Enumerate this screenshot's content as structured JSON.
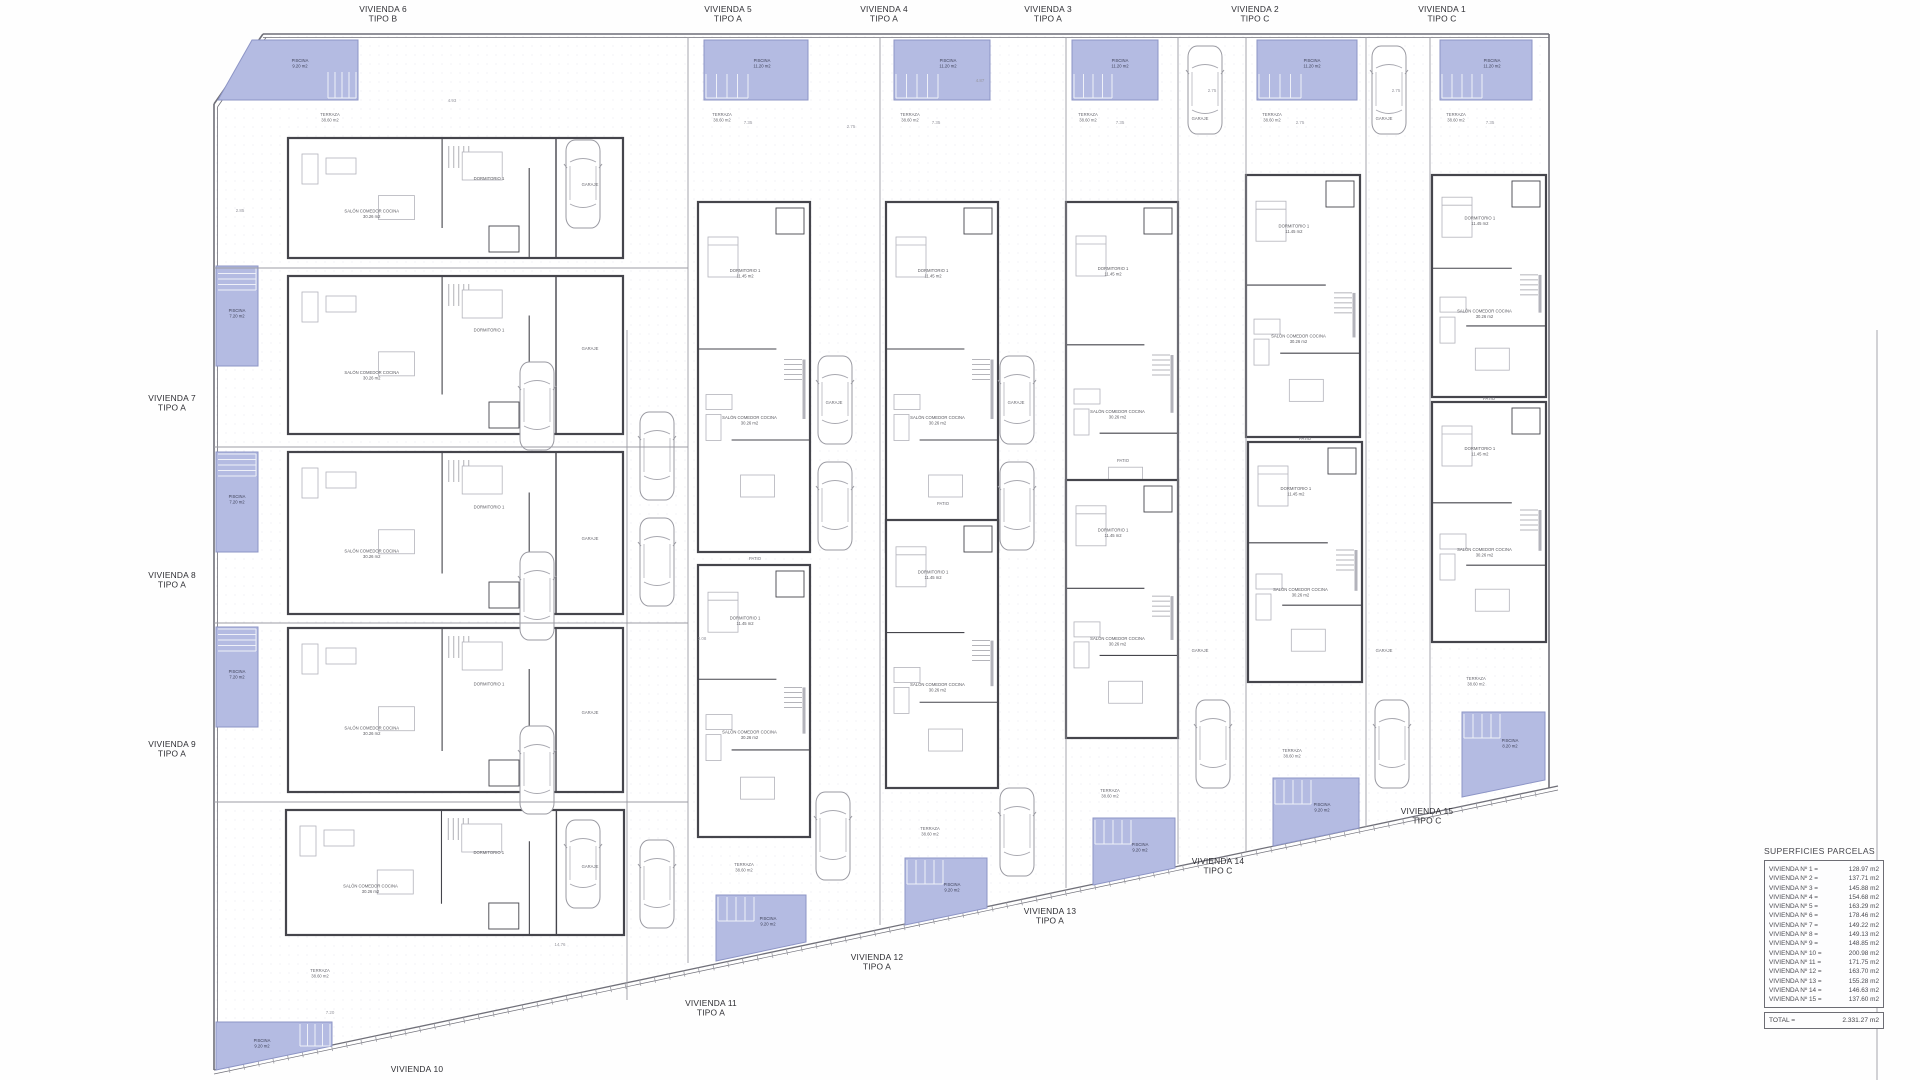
{
  "palette": {
    "pool_fill": "#b4bbe2",
    "pool_edge": "#8d95c6",
    "pool_text": "#3f4258",
    "wall": "#45454c",
    "lite": "#9c9ca4",
    "furn": "#b3b3bb",
    "faint": "#d9d9e0",
    "text": "#2e2e33",
    "gray": "#96969e",
    "stair": "#eef0f8"
  },
  "strings": {
    "salon": "SALÓN COMEDOR COCINA",
    "salon_area": "30.26 m2",
    "dorm": "DORMITORIO 1",
    "dorm_area": "11.45 m2",
    "terraza": "TERRAZA",
    "terraza_area": "38.60 m2",
    "piscina": "PISCINA",
    "garaje": "GARAJE",
    "patio": "PATIO",
    "bano": "BAÑO 1"
  },
  "table": {
    "title": "SUPERFICIES PARCELAS",
    "rows": [
      {
        "label": "VIVIENDA Nº 1 =",
        "value": "128.97 m2"
      },
      {
        "label": "VIVIENDA Nº 2 =",
        "value": "137.71 m2"
      },
      {
        "label": "VIVIENDA Nº 3 =",
        "value": "145.88 m2"
      },
      {
        "label": "VIVIENDA Nº 4 =",
        "value": "154.68 m2"
      },
      {
        "label": "VIVIENDA Nº 5 =",
        "value": "163.29 m2"
      },
      {
        "label": "VIVIENDA Nº 6 =",
        "value": "178.46 m2"
      },
      {
        "label": "VIVIENDA Nº 7 =",
        "value": "149.22 m2"
      },
      {
        "label": "VIVIENDA Nº 8 =",
        "value": "149.13 m2"
      },
      {
        "label": "VIVIENDA Nº 9 =",
        "value": "148.85 m2"
      },
      {
        "label": "VIVIENDA Nº 10 =",
        "value": "200.98 m2"
      },
      {
        "label": "VIVIENDA Nº 11 =",
        "value": "171.75 m2"
      },
      {
        "label": "VIVIENDA Nº 12 =",
        "value": "163.70 m2"
      },
      {
        "label": "VIVIENDA Nº 13 =",
        "value": "155.28 m2"
      },
      {
        "label": "VIVIENDA Nº 14 =",
        "value": "146.63 m2"
      },
      {
        "label": "VIVIENDA Nº 15 =",
        "value": "137.60 m2"
      }
    ],
    "total_label": "TOTAL =",
    "total_value": "2.331.27 m2"
  },
  "plan": {
    "unit_labels": [
      {
        "line1": "VIVIENDA 6",
        "line2": "TIPO B",
        "x": 383,
        "y": 12
      },
      {
        "line1": "VIVIENDA 5",
        "line2": "TIPO A",
        "x": 728,
        "y": 12
      },
      {
        "line1": "VIVIENDA 4",
        "line2": "TIPO A",
        "x": 884,
        "y": 12
      },
      {
        "line1": "VIVIENDA 3",
        "line2": "TIPO A",
        "x": 1048,
        "y": 12
      },
      {
        "line1": "VIVIENDA 2",
        "line2": "TIPO C",
        "x": 1255,
        "y": 12
      },
      {
        "line1": "VIVIENDA 1",
        "line2": "TIPO C",
        "x": 1442,
        "y": 12
      },
      {
        "line1": "VIVIENDA 7",
        "line2": "TIPO A",
        "x": 172,
        "y": 401
      },
      {
        "line1": "VIVIENDA 8",
        "line2": "TIPO A",
        "x": 172,
        "y": 578
      },
      {
        "line1": "VIVIENDA 9",
        "line2": "TIPO A",
        "x": 172,
        "y": 747
      },
      {
        "line1": "VIVIENDA 10",
        "line2": "",
        "x": 417,
        "y": 1072
      },
      {
        "line1": "VIVIENDA 11",
        "line2": "TIPO A",
        "x": 711,
        "y": 1006
      },
      {
        "line1": "VIVIENDA 12",
        "line2": "TIPO A",
        "x": 877,
        "y": 960
      },
      {
        "line1": "VIVIENDA 13",
        "line2": "TIPO A",
        "x": 1050,
        "y": 914
      },
      {
        "line1": "VIVIENDA 14",
        "line2": "TIPO C",
        "x": 1218,
        "y": 864
      },
      {
        "line1": "VIVIENDA 15",
        "line2": "TIPO C",
        "x": 1427,
        "y": 814
      }
    ],
    "boundary": [
      {
        "p": [
          263,
          34,
          1549,
          34
        ],
        "w": 1.6
      },
      {
        "p": [
          263,
          37.5,
          1549,
          37.5
        ],
        "w": 0.8
      },
      {
        "p": [
          214,
          104,
          263,
          34
        ],
        "w": 1.6
      },
      {
        "p": [
          217.5,
          107,
          266,
          37.5
        ],
        "w": 0.8
      },
      {
        "p": [
          214,
          104,
          214,
          1070
        ],
        "w": 1.6
      },
      {
        "p": [
          217.5,
          107,
          217.5,
          1068
        ],
        "w": 0.8
      },
      {
        "p": [
          1549,
          34,
          1549,
          788
        ],
        "w": 1.6
      },
      {
        "p": [
          214,
          1070,
          1558,
          786
        ],
        "w": 1.3
      },
      {
        "p": [
          214,
          1074,
          1558,
          790
        ],
        "w": 0.7
      }
    ],
    "party_lines": [
      [
        688,
        37,
        688,
        963
      ],
      [
        880,
        37,
        880,
        925
      ],
      [
        1066,
        37,
        1066,
        888
      ],
      [
        1178,
        37,
        1178,
        864
      ],
      [
        1246,
        37,
        1246,
        851
      ],
      [
        1366,
        37,
        1366,
        827
      ],
      [
        1430,
        37,
        1430,
        814
      ],
      [
        627,
        330,
        627,
        1000
      ],
      [
        214,
        268,
        688,
        268
      ],
      [
        214,
        447,
        688,
        447
      ],
      [
        214,
        623,
        688,
        623
      ],
      [
        214,
        802,
        688,
        802
      ],
      [
        1877,
        330,
        1877,
        1080
      ]
    ],
    "pools": [
      {
        "pts": "252,40 358,40 358,100 218,100",
        "stair": {
          "x": 328,
          "y": 72,
          "w": 28,
          "h": 26,
          "d": "v"
        },
        "lx": 300,
        "ly": 62,
        "area": "9.20 m2"
      },
      {
        "pts": "704,40 808,40 808,100 704,100",
        "stair": {
          "x": 706,
          "y": 74,
          "w": 42,
          "h": 24,
          "d": "v"
        },
        "lx": 762,
        "ly": 62,
        "area": "11.20 m2"
      },
      {
        "pts": "894,40 990,40 990,100 894,100",
        "stair": {
          "x": 896,
          "y": 74,
          "w": 42,
          "h": 24,
          "d": "v"
        },
        "lx": 948,
        "ly": 62,
        "area": "11.20 m2"
      },
      {
        "pts": "1072,40 1158,40 1158,100 1072,100",
        "stair": {
          "x": 1074,
          "y": 74,
          "w": 38,
          "h": 24,
          "d": "v"
        },
        "lx": 1120,
        "ly": 62,
        "area": "11.20 m2"
      },
      {
        "pts": "1257,40 1357,40 1357,100 1257,100",
        "stair": {
          "x": 1259,
          "y": 74,
          "w": 42,
          "h": 24,
          "d": "v"
        },
        "lx": 1312,
        "ly": 62,
        "area": "11.20 m2"
      },
      {
        "pts": "1440,40 1532,40 1532,100 1440,100",
        "stair": {
          "x": 1442,
          "y": 74,
          "w": 40,
          "h": 24,
          "d": "v"
        },
        "lx": 1492,
        "ly": 62,
        "area": "11.20 m2"
      },
      {
        "pts": "216,266 258,266 258,366 216,366",
        "stair": {
          "x": 218,
          "y": 268,
          "w": 38,
          "h": 22,
          "d": "h"
        },
        "lx": 237,
        "ly": 312,
        "area": "7.20 m2"
      },
      {
        "pts": "216,452 258,452 258,552 216,552",
        "stair": {
          "x": 218,
          "y": 454,
          "w": 38,
          "h": 22,
          "d": "h"
        },
        "lx": 237,
        "ly": 498,
        "area": "7.20 m2"
      },
      {
        "pts": "216,627 258,627 258,727 216,727",
        "stair": {
          "x": 218,
          "y": 629,
          "w": 38,
          "h": 22,
          "d": "h"
        },
        "lx": 237,
        "ly": 673,
        "area": "7.20 m2"
      },
      {
        "pts": "216,1022 332,1022 332,1046 216,1070",
        "stair": {
          "x": 300,
          "y": 1024,
          "w": 30,
          "h": 22,
          "d": "v"
        },
        "lx": 262,
        "ly": 1042,
        "area": "9.20 m2"
      },
      {
        "pts": "716,895 806,895 806,942 716,961",
        "stair": {
          "x": 718,
          "y": 897,
          "w": 36,
          "h": 24,
          "d": "v"
        },
        "lx": 768,
        "ly": 920,
        "area": "9.20 m2"
      },
      {
        "pts": "905,858 987,858 987,908 905,925",
        "stair": {
          "x": 907,
          "y": 860,
          "w": 36,
          "h": 24,
          "d": "v"
        },
        "lx": 952,
        "ly": 886,
        "area": "9.20 m2"
      },
      {
        "pts": "1093,818 1175,818 1175,868 1093,885",
        "stair": {
          "x": 1095,
          "y": 820,
          "w": 36,
          "h": 24,
          "d": "v"
        },
        "lx": 1140,
        "ly": 846,
        "area": "9.20 m2"
      },
      {
        "pts": "1273,778 1359,778 1359,828 1273,846",
        "stair": {
          "x": 1275,
          "y": 780,
          "w": 36,
          "h": 24,
          "d": "v"
        },
        "lx": 1322,
        "ly": 806,
        "area": "9.20 m2"
      },
      {
        "pts": "1462,712 1545,712 1545,780 1462,797",
        "stair": {
          "x": 1464,
          "y": 714,
          "w": 36,
          "h": 24,
          "d": "v"
        },
        "lx": 1510,
        "ly": 742,
        "area": "8.20 m2"
      }
    ],
    "houses": [
      {
        "x": 288,
        "y": 138,
        "w": 335,
        "h": 120,
        "o": "h"
      },
      {
        "x": 288,
        "y": 276,
        "w": 335,
        "h": 158,
        "o": "h"
      },
      {
        "x": 288,
        "y": 452,
        "w": 335,
        "h": 162,
        "o": "h"
      },
      {
        "x": 288,
        "y": 628,
        "w": 335,
        "h": 164,
        "o": "h"
      },
      {
        "x": 286,
        "y": 810,
        "w": 338,
        "h": 125,
        "o": "h"
      },
      {
        "x": 698,
        "y": 202,
        "w": 112,
        "h": 350,
        "o": "v"
      },
      {
        "x": 886,
        "y": 202,
        "w": 112,
        "h": 350,
        "o": "v"
      },
      {
        "x": 1066,
        "y": 202,
        "w": 112,
        "h": 340,
        "o": "v"
      },
      {
        "x": 1246,
        "y": 175,
        "w": 114,
        "h": 262,
        "o": "v"
      },
      {
        "x": 1432,
        "y": 175,
        "w": 114,
        "h": 222,
        "o": "v"
      },
      {
        "x": 698,
        "y": 565,
        "w": 112,
        "h": 272,
        "o": "v"
      },
      {
        "x": 886,
        "y": 520,
        "w": 112,
        "h": 268,
        "o": "v"
      },
      {
        "x": 1066,
        "y": 480,
        "w": 112,
        "h": 258,
        "o": "v"
      },
      {
        "x": 1248,
        "y": 442,
        "w": 114,
        "h": 240,
        "o": "v"
      },
      {
        "x": 1432,
        "y": 402,
        "w": 114,
        "h": 240,
        "o": "v"
      }
    ],
    "cars": [
      [
        566,
        140
      ],
      [
        520,
        362
      ],
      [
        520,
        552
      ],
      [
        520,
        726
      ],
      [
        566,
        820
      ],
      [
        640,
        412
      ],
      [
        640,
        518
      ],
      [
        640,
        840
      ],
      [
        818,
        356
      ],
      [
        818,
        462
      ],
      [
        816,
        792
      ],
      [
        1000,
        356
      ],
      [
        1000,
        462
      ],
      [
        1000,
        788
      ],
      [
        1188,
        46
      ],
      [
        1196,
        700
      ],
      [
        1372,
        46
      ],
      [
        1375,
        700
      ]
    ],
    "terrazas": [
      {
        "x": 330,
        "y": 116
      },
      {
        "x": 722,
        "y": 116
      },
      {
        "x": 910,
        "y": 116
      },
      {
        "x": 1088,
        "y": 116
      },
      {
        "x": 1272,
        "y": 116
      },
      {
        "x": 1456,
        "y": 116
      },
      {
        "x": 320,
        "y": 972
      },
      {
        "x": 744,
        "y": 866
      },
      {
        "x": 930,
        "y": 830
      },
      {
        "x": 1110,
        "y": 792
      },
      {
        "x": 1292,
        "y": 752
      },
      {
        "x": 1476,
        "y": 680
      }
    ],
    "patios": [
      {
        "x": 755,
        "y": 560
      },
      {
        "x": 943,
        "y": 505
      },
      {
        "x": 1123,
        "y": 462
      },
      {
        "x": 1305,
        "y": 440
      },
      {
        "x": 1489,
        "y": 400
      }
    ],
    "garajes": [
      {
        "x": 590,
        "y": 186
      },
      {
        "x": 590,
        "y": 350
      },
      {
        "x": 590,
        "y": 540
      },
      {
        "x": 590,
        "y": 714
      },
      {
        "x": 590,
        "y": 868
      },
      {
        "x": 834,
        "y": 404
      },
      {
        "x": 1016,
        "y": 404
      },
      {
        "x": 1200,
        "y": 120
      },
      {
        "x": 1384,
        "y": 120
      },
      {
        "x": 1200,
        "y": 652
      },
      {
        "x": 1384,
        "y": 652
      }
    ],
    "dims": [
      {
        "x": 748,
        "y": 124,
        "t": "7.35"
      },
      {
        "x": 851,
        "y": 128,
        "t": "2.75"
      },
      {
        "x": 936,
        "y": 124,
        "t": "7.35"
      },
      {
        "x": 1120,
        "y": 124,
        "t": "7.35"
      },
      {
        "x": 1300,
        "y": 124,
        "t": "2.75"
      },
      {
        "x": 1490,
        "y": 124,
        "t": "7.35"
      },
      {
        "x": 240,
        "y": 212,
        "t": "2.85"
      },
      {
        "x": 452,
        "y": 102,
        "t": "4.93"
      },
      {
        "x": 702,
        "y": 640,
        "t": "3.08"
      },
      {
        "x": 1212,
        "y": 92,
        "t": "2.75"
      },
      {
        "x": 1396,
        "y": 92,
        "t": "2.75"
      },
      {
        "x": 560,
        "y": 946,
        "t": "14.76"
      },
      {
        "x": 980,
        "y": 82,
        "t": "4.87"
      },
      {
        "x": 330,
        "y": 1014,
        "t": "7.20"
      }
    ]
  }
}
